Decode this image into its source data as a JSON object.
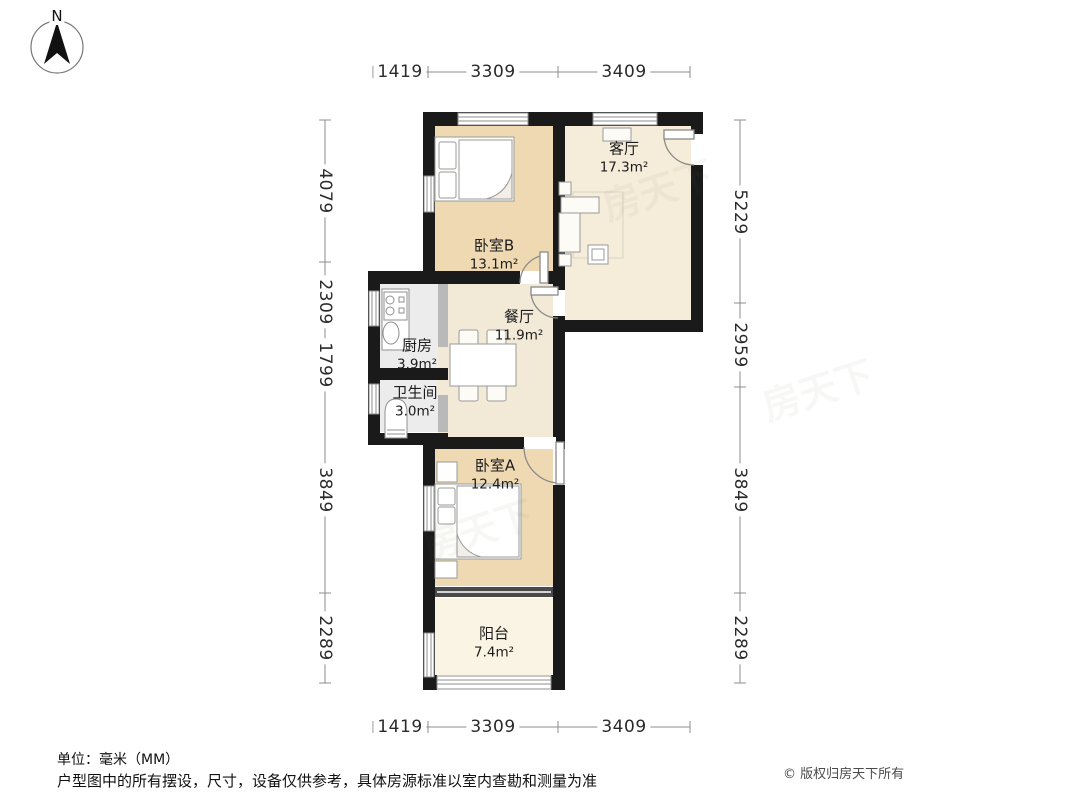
{
  "compass": {
    "label": "N"
  },
  "rooms": [
    {
      "name": "客厅",
      "area": "17.3m²"
    },
    {
      "name": "卧室B",
      "area": "13.1m²"
    },
    {
      "name": "餐厅",
      "area": "11.9m²"
    },
    {
      "name": "厨房",
      "area": "3.9m²"
    },
    {
      "name": "卫生间",
      "area": "3.0m²"
    },
    {
      "name": "卧室A",
      "area": "12.4m²"
    },
    {
      "name": "阳台",
      "area": "7.4m²"
    }
  ],
  "dimensions": {
    "unit": "mm",
    "top": [
      "1419",
      "3309",
      "3409"
    ],
    "bottom": [
      "1419",
      "3309",
      "3409"
    ],
    "left": [
      "4079",
      "2309",
      "1799",
      "3849",
      "2289"
    ],
    "right": [
      "5229",
      "2959",
      "3849",
      "2289"
    ]
  },
  "footer": {
    "unit": "单位：毫米（MM）",
    "disclaimer": "户型图中的所有摆设，尺寸，设备仅供参考，具体房源标准以室内查勘和测量为准",
    "copyright": "© 版权归房天下所有"
  },
  "watermark": "房天下",
  "colors": {
    "wall": "#1a1a1a",
    "bedroom_floor": "#eed9b3",
    "hall_floor": "#f5ecda",
    "dining_floor": "#f3e9d7",
    "service_floor": "#ececec",
    "balcony_floor": "#f9f4e3",
    "dimension_line": "#8c8c8c"
  }
}
